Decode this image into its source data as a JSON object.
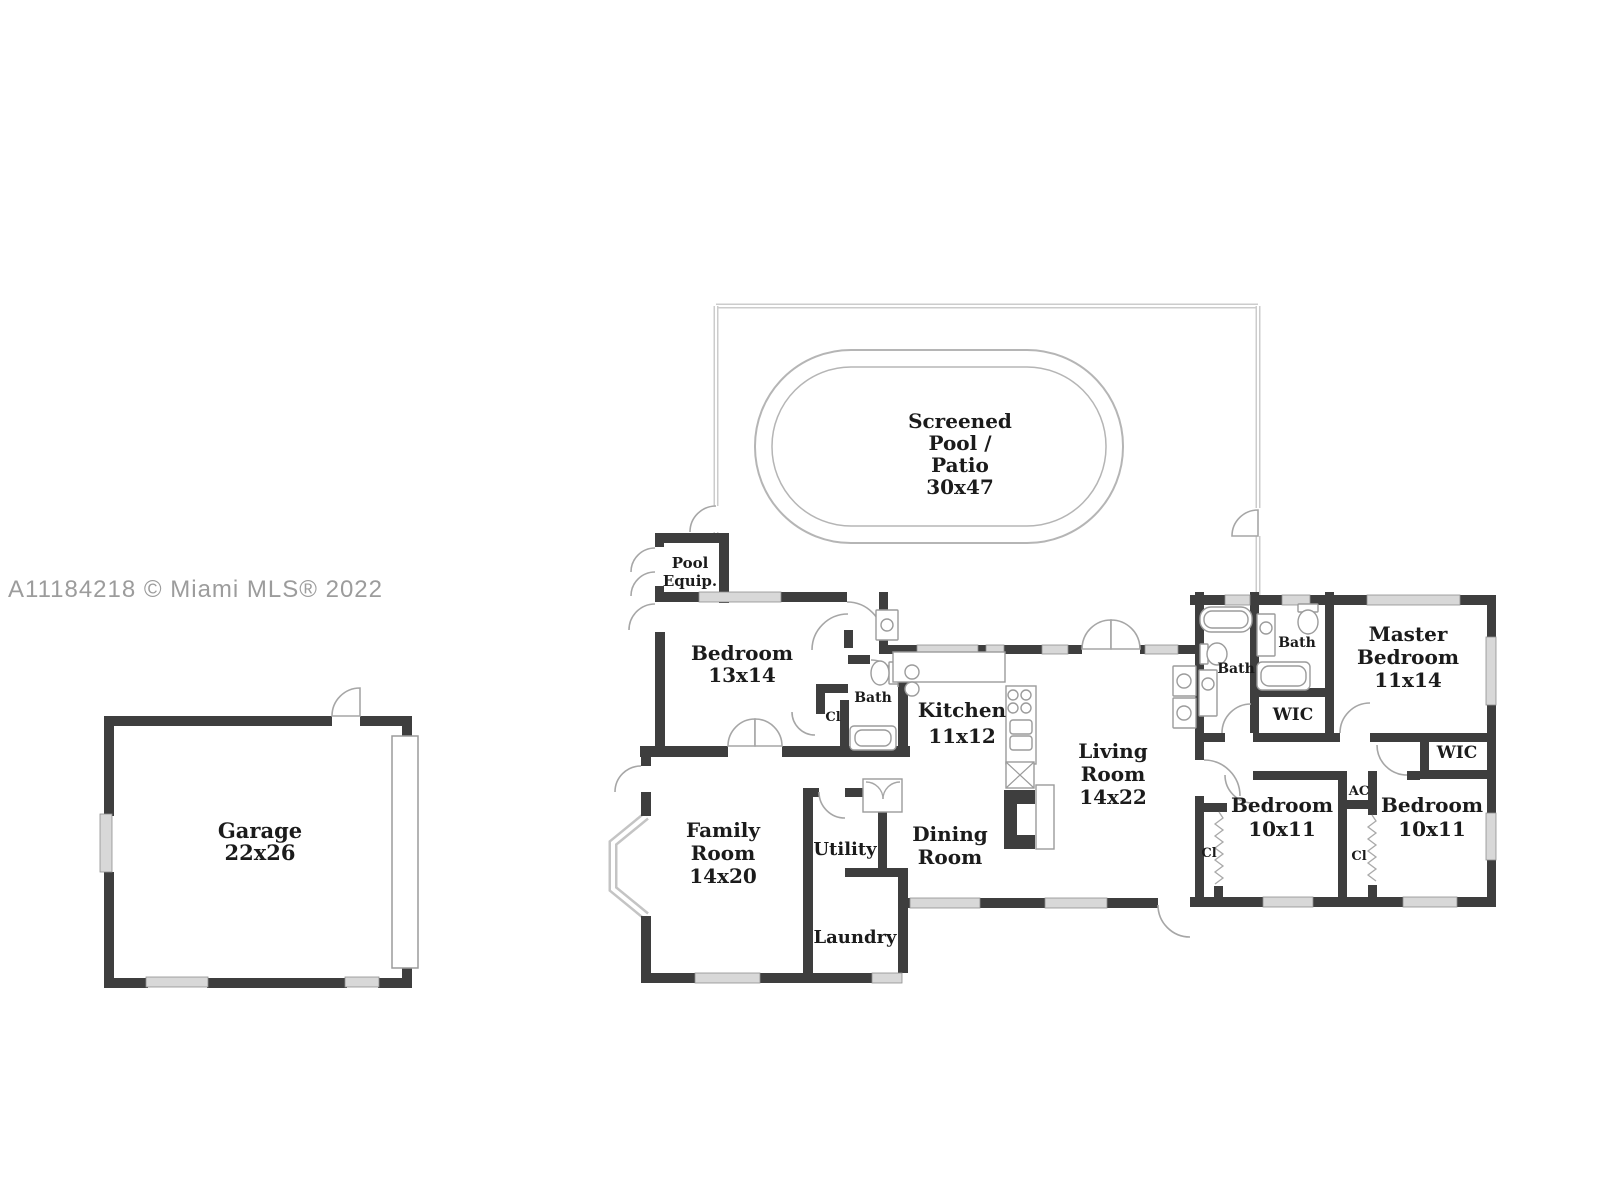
{
  "watermark": {
    "text": "A11184218 © Miami MLS® 2022",
    "color": "#9c9c9c"
  },
  "colors": {
    "wall": "#3e3e3e",
    "window_fill": "#d8d8d8",
    "window_stroke": "#8f8f8f",
    "fixture_stroke": "#9b9b9b",
    "pool_stroke": "#b5b5b5",
    "enclosure_stroke": "#cccccc",
    "label_text": "#1b1b1b"
  },
  "rooms": [
    {
      "id": "screened-pool-patio",
      "lines": [
        "Screened",
        "Pool /",
        "Patio",
        "30x47"
      ],
      "x": 960,
      "y": 428,
      "fs": 20,
      "lh": 22
    },
    {
      "id": "pool-equip",
      "lines": [
        "Pool",
        "Equip."
      ],
      "x": 690,
      "y": 568,
      "fs": 15,
      "lh": 18
    },
    {
      "id": "bedroom-13x14",
      "lines": [
        "Bedroom",
        "13x14"
      ],
      "x": 742,
      "y": 660,
      "fs": 20,
      "lh": 22
    },
    {
      "id": "bath-hall",
      "lines": [
        "Bath"
      ],
      "x": 873,
      "y": 702,
      "fs": 14,
      "lh": 16
    },
    {
      "id": "closet-bedroom",
      "lines": [
        "Cl"
      ],
      "x": 833,
      "y": 721,
      "fs": 13,
      "lh": 15
    },
    {
      "id": "kitchen",
      "lines": [
        "Kitchen",
        "11x12"
      ],
      "x": 962,
      "y": 717,
      "fs": 20,
      "lh": 26
    },
    {
      "id": "living-room",
      "lines": [
        "Living",
        "Room",
        "14x22"
      ],
      "x": 1113,
      "y": 758,
      "fs": 20,
      "lh": 23
    },
    {
      "id": "dining-room",
      "lines": [
        "Dining",
        "Room"
      ],
      "x": 950,
      "y": 841,
      "fs": 20,
      "lh": 23
    },
    {
      "id": "family-room",
      "lines": [
        "Family",
        "Room",
        "14x20"
      ],
      "x": 723,
      "y": 837,
      "fs": 20,
      "lh": 23
    },
    {
      "id": "utility",
      "lines": [
        "Utility"
      ],
      "x": 845,
      "y": 855,
      "fs": 18,
      "lh": 20
    },
    {
      "id": "laundry",
      "lines": [
        "Laundry"
      ],
      "x": 855,
      "y": 943,
      "fs": 18,
      "lh": 20
    },
    {
      "id": "garage",
      "lines": [
        "Garage",
        "22x26"
      ],
      "x": 260,
      "y": 838,
      "fs": 21,
      "lh": 22
    },
    {
      "id": "bath-1",
      "lines": [
        "Bath"
      ],
      "x": 1236,
      "y": 673,
      "fs": 14,
      "lh": 16
    },
    {
      "id": "bath-2",
      "lines": [
        "Bath"
      ],
      "x": 1297,
      "y": 647,
      "fs": 14,
      "lh": 16
    },
    {
      "id": "master-bedroom",
      "lines": [
        "Master",
        "Bedroom",
        "11x14"
      ],
      "x": 1408,
      "y": 641,
      "fs": 20,
      "lh": 23
    },
    {
      "id": "wic-master",
      "lines": [
        "WIC"
      ],
      "x": 1293,
      "y": 720,
      "fs": 17,
      "lh": 18
    },
    {
      "id": "wic-right",
      "lines": [
        "WIC"
      ],
      "x": 1457,
      "y": 758,
      "fs": 17,
      "lh": 18
    },
    {
      "id": "bedroom-left",
      "lines": [
        "Bedroom",
        "10x11"
      ],
      "x": 1282,
      "y": 812,
      "fs": 20,
      "lh": 24
    },
    {
      "id": "ac",
      "lines": [
        "AC"
      ],
      "x": 1359,
      "y": 795,
      "fs": 13,
      "lh": 15
    },
    {
      "id": "closet-left",
      "lines": [
        "Cl"
      ],
      "x": 1209,
      "y": 857,
      "fs": 13,
      "lh": 15
    },
    {
      "id": "closet-right",
      "lines": [
        "Cl"
      ],
      "x": 1359,
      "y": 860,
      "fs": 13,
      "lh": 15
    },
    {
      "id": "bedroom-right",
      "lines": [
        "Bedroom",
        "10x11"
      ],
      "x": 1432,
      "y": 812,
      "fs": 20,
      "lh": 24
    }
  ]
}
